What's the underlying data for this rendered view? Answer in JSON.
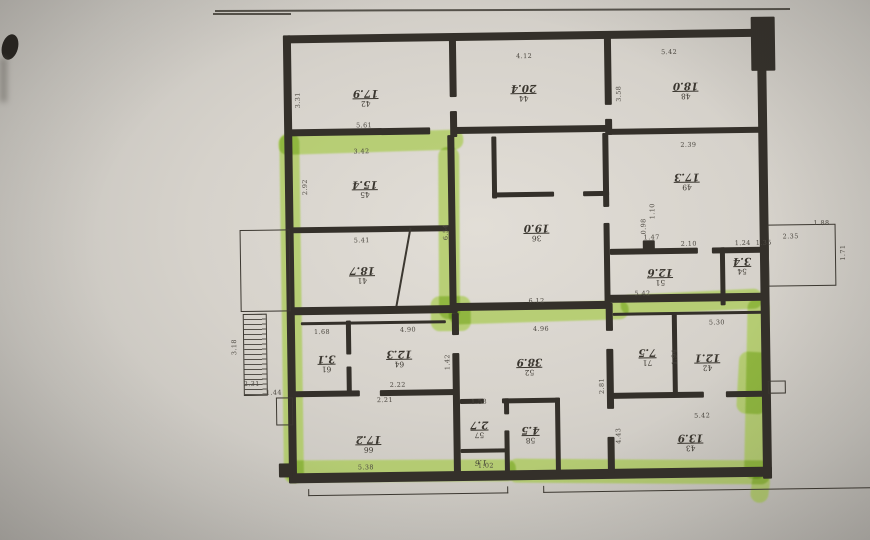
{
  "colors": {
    "paper": "#d6d2cb",
    "ink": "#34302a",
    "marker": "#a9cb52",
    "pencil": "#4e4a43"
  },
  "rooms": [
    {
      "id": "room-17-9",
      "num": "42",
      "area": "17.9"
    },
    {
      "id": "room-20-4",
      "num": "44",
      "area": "20.4"
    },
    {
      "id": "room-18-0",
      "num": "48",
      "area": "18.0"
    },
    {
      "id": "room-15-4",
      "num": "45",
      "area": "15.4"
    },
    {
      "id": "room-18-7",
      "num": "41",
      "area": "18.7"
    },
    {
      "id": "room-19-0",
      "num": "36",
      "area": "19.0"
    },
    {
      "id": "room-17-3",
      "num": "49",
      "area": "17.3"
    },
    {
      "id": "room-12-6",
      "num": "51",
      "area": "12.6"
    },
    {
      "id": "room-3-4",
      "num": "54",
      "area": "3.4"
    },
    {
      "id": "room-3-1",
      "num": "61",
      "area": "3.1"
    },
    {
      "id": "room-12-3",
      "num": "64",
      "area": "12.3"
    },
    {
      "id": "room-17-2",
      "num": "66",
      "area": "17.2"
    },
    {
      "id": "room-38-9",
      "num": "52",
      "area": "38.9"
    },
    {
      "id": "room-2-7",
      "num": "57",
      "area": "2.7"
    },
    {
      "id": "room-4-5",
      "num": "58",
      "area": "4.5"
    },
    {
      "id": "room-1-6",
      "num": "",
      "area": "1.6"
    },
    {
      "id": "room-7-5",
      "num": "71",
      "area": "7.5"
    },
    {
      "id": "room-12-1",
      "num": "42",
      "area": "12.1"
    },
    {
      "id": "room-13-9",
      "num": "43",
      "area": "13.9"
    }
  ],
  "dims": [
    {
      "v": "4.12"
    },
    {
      "v": "5.42"
    },
    {
      "v": "3.31"
    },
    {
      "v": "3.58"
    },
    {
      "v": "5.61"
    },
    {
      "v": "3.42"
    },
    {
      "v": "2.92"
    },
    {
      "v": "5.41"
    },
    {
      "v": "6.54"
    },
    {
      "v": "2.39"
    },
    {
      "v": "1.47"
    },
    {
      "v": "0.98"
    },
    {
      "v": "2.10"
    },
    {
      "v": "1.24"
    },
    {
      "v": "2.35"
    },
    {
      "v": "1.88"
    },
    {
      "v": "1.71"
    },
    {
      "v": "6.12"
    },
    {
      "v": "5.42"
    },
    {
      "v": "4.96"
    },
    {
      "v": "2.81"
    },
    {
      "v": "1.68"
    },
    {
      "v": "4.90"
    },
    {
      "v": "2.22"
    },
    {
      "v": "1.42"
    },
    {
      "v": "2.21"
    },
    {
      "v": "5.38"
    },
    {
      "v": "1.44"
    },
    {
      "v": "3.18"
    },
    {
      "v": "2.31"
    },
    {
      "v": "1.58"
    },
    {
      "v": "1.02"
    },
    {
      "v": "5.30"
    },
    {
      "v": "1.94"
    },
    {
      "v": "5.42"
    },
    {
      "v": "4.43"
    },
    {
      "v": "1.35"
    },
    {
      "v": "1.10"
    }
  ]
}
